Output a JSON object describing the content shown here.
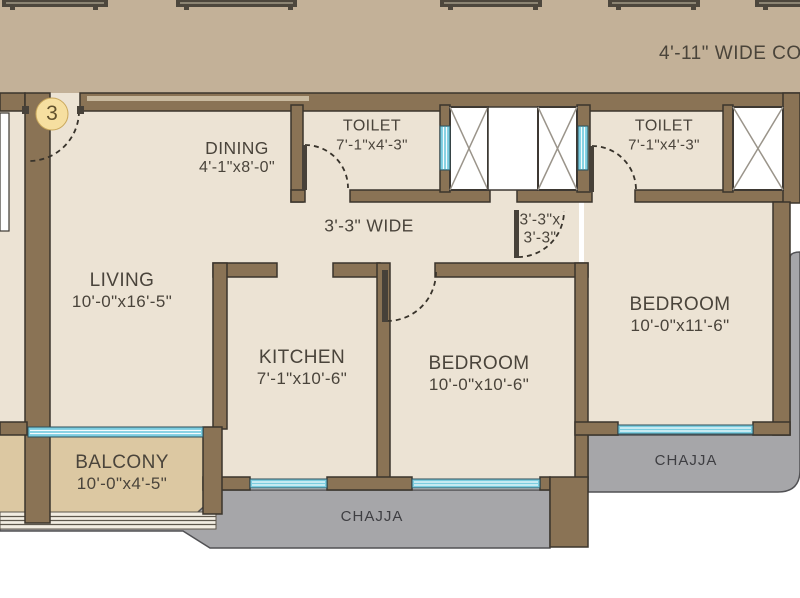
{
  "floor_plan": {
    "corridor": {
      "label": "4'-11\" WIDE COR"
    },
    "unit_number": "3",
    "rooms": {
      "dining": {
        "name": "DINING",
        "dims": "4'-1\"x8'-0\""
      },
      "toilet_left": {
        "name": "TOILET",
        "dims": "7'-1\"x4'-3\""
      },
      "toilet_right": {
        "name": "TOILET",
        "dims": "7'-1\"x4'-3\""
      },
      "living": {
        "name": "LIVING",
        "dims": "10'-0\"x16'-5\""
      },
      "kitchen": {
        "name": "KITCHEN",
        "dims": "7'-1\"x10'-6\""
      },
      "bedroom_mid": {
        "name": "BEDROOM",
        "dims": "10'-0\"x10'-6\""
      },
      "bedroom_right": {
        "name": "BEDROOM",
        "dims": "10'-0\"x11'-6\""
      },
      "balcony": {
        "name": "BALCONY",
        "dims": "10'-0\"x4'-5\""
      }
    },
    "passage": {
      "label": "3'-3\" WIDE"
    },
    "lobby": {
      "line1": "3'-3\"x",
      "line2": "3'-3\""
    },
    "chajja_bottom": "CHAJJA",
    "chajja_right": "CHAJJA",
    "colors": {
      "wall": "#8a7355",
      "corridor": "#c3b198",
      "room": "#ece3d4",
      "balcony": "#dcc8a2",
      "chajja": "#a6a6a9",
      "window": "#7bcde0",
      "unit_badge": "#f6dfa0"
    }
  }
}
